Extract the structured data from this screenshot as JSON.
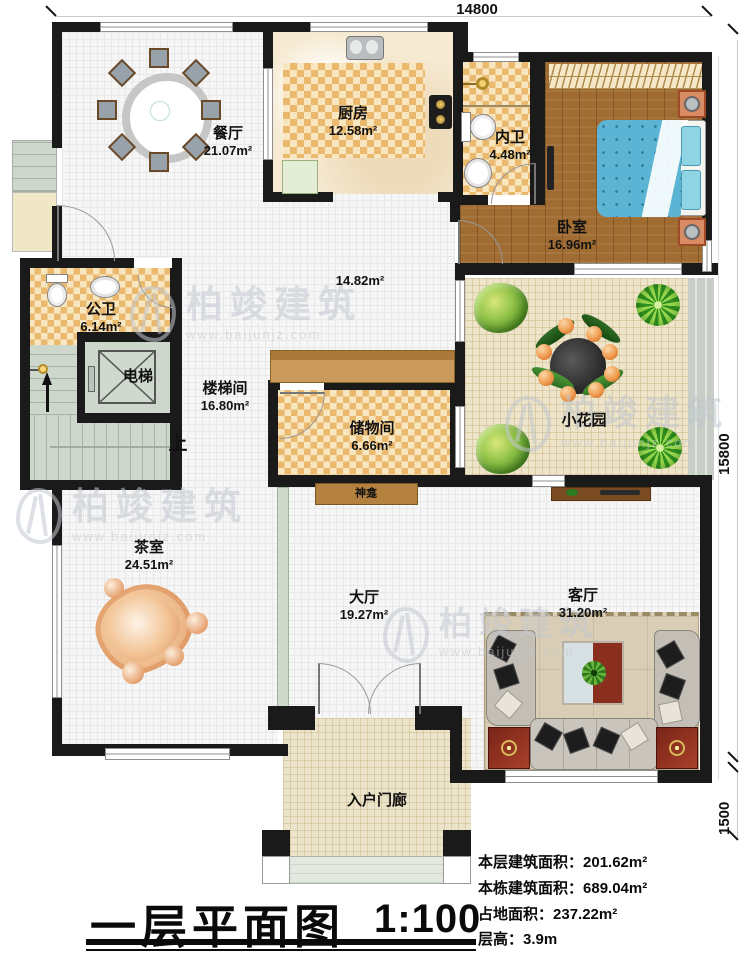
{
  "watermark": {
    "brand": "柏竣建筑",
    "url": "www.baijunjz.com"
  },
  "dimensions": {
    "top": "14800",
    "right": "15800",
    "right_lower": "1500"
  },
  "annotations": {
    "up": "上",
    "corridor_area": "14.82m²"
  },
  "rooms": {
    "dining": {
      "name": "餐厅",
      "area": "21.07m²"
    },
    "kitchen": {
      "name": "厨房",
      "area": "12.58m²"
    },
    "inner_bath": {
      "name": "内卫",
      "area": "4.48m²"
    },
    "bedroom": {
      "name": "卧室",
      "area": "16.96m²"
    },
    "public_bath": {
      "name": "公卫",
      "area": "6.14m²"
    },
    "elevator": {
      "name": "电梯"
    },
    "stairwell": {
      "name": "楼梯间",
      "area": "16.80m²"
    },
    "storage": {
      "name": "储物间",
      "area": "6.66m²"
    },
    "shrine": {
      "name": "神龛"
    },
    "garden": {
      "name": "小花园"
    },
    "tea_room": {
      "name": "茶室",
      "area": "24.51m²"
    },
    "hall": {
      "name": "大厅",
      "area": "19.27m²"
    },
    "living": {
      "name": "客厅",
      "area": "31.20m²"
    },
    "porch": {
      "name": "入户门廊"
    }
  },
  "title_block": {
    "title": "一层平面图",
    "scale": "1:100"
  },
  "stats": [
    {
      "label": "本层建筑面积：",
      "value": "201.62m²"
    },
    {
      "label": "本栋建筑面积：",
      "value": "689.04m²"
    },
    {
      "label": "占地面积：",
      "value": "237.22m²"
    },
    {
      "label": "层高：",
      "value": "3.9m"
    }
  ],
  "colors": {
    "wall": "#1a1a1a",
    "checker": "#eab96e",
    "wood": "#a06c32",
    "bed_blue": "#5fb7d2",
    "stairs": "#cdd7cc",
    "garden_floor": "#ede4c9",
    "rug": "#d9cdb5",
    "cabinet_red": "#8a2c1b",
    "counter": "#c0904f",
    "stone": "#eec79b"
  }
}
